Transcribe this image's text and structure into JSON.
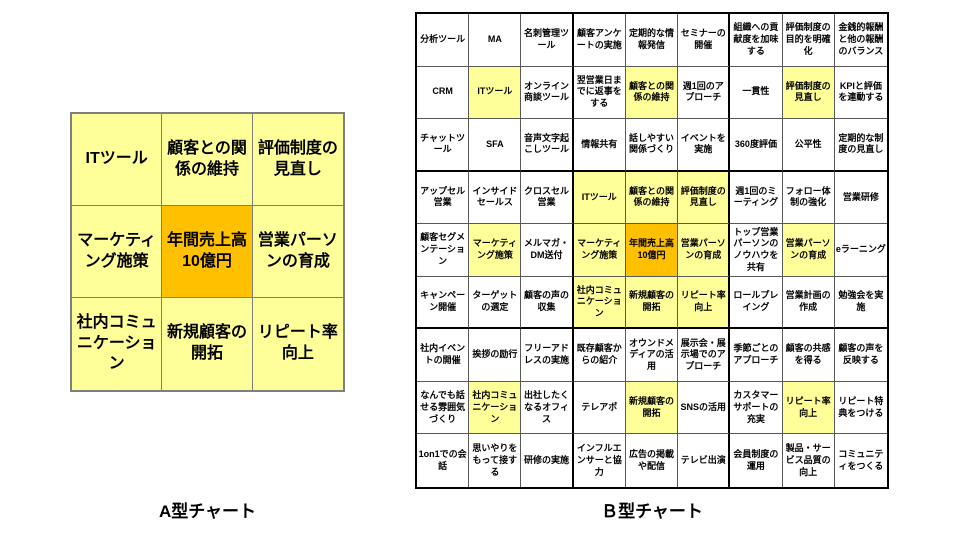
{
  "colors": {
    "highlight_yellow": "#FFFF99",
    "center_orange": "#FFC000",
    "default_white": "#FFFFFF",
    "grid_line_a": "#7F7F7F",
    "grid_line_b_inner": "#595959",
    "grid_line_b_block": "#000000"
  },
  "chart_a": {
    "caption": "А型チャート",
    "rows": [
      [
        {
          "t": "ITツール",
          "c": "yellow"
        },
        {
          "t": "顧客との関係の維持",
          "c": "yellow"
        },
        {
          "t": "評価制度の見直し",
          "c": "yellow"
        }
      ],
      [
        {
          "t": "マーケティング施策",
          "c": "yellow"
        },
        {
          "t": "年間売上高10億円",
          "c": "orange"
        },
        {
          "t": "営業パーソンの育成",
          "c": "yellow"
        }
      ],
      [
        {
          "t": "社内コミュニケーション",
          "c": "yellow"
        },
        {
          "t": "新規顧客の開拓",
          "c": "yellow"
        },
        {
          "t": "リピート率向上",
          "c": "yellow"
        }
      ]
    ]
  },
  "chart_b": {
    "caption": "Ｂ型チャート",
    "rows": [
      [
        {
          "t": "分析ツール",
          "c": "white"
        },
        {
          "t": "MA",
          "c": "white"
        },
        {
          "t": "名刺管理ツール",
          "c": "white"
        },
        {
          "t": "顧客アンケートの実施",
          "c": "white"
        },
        {
          "t": "定期的な情報発信",
          "c": "white"
        },
        {
          "t": "セミナーの開催",
          "c": "white"
        },
        {
          "t": "組織への貢献度を加味する",
          "c": "white"
        },
        {
          "t": "評価制度の目的を明確化",
          "c": "white"
        },
        {
          "t": "金銭的報酬と他の報酬のバランス",
          "c": "white"
        }
      ],
      [
        {
          "t": "CRM",
          "c": "white"
        },
        {
          "t": "ITツール",
          "c": "yellow"
        },
        {
          "t": "オンライン商談ツール",
          "c": "white"
        },
        {
          "t": "翌営業日までに返事をする",
          "c": "white"
        },
        {
          "t": "顧客との関係の維持",
          "c": "yellow"
        },
        {
          "t": "週1回のアプローチ",
          "c": "white"
        },
        {
          "t": "一貫性",
          "c": "white"
        },
        {
          "t": "評価制度の見直し",
          "c": "yellow"
        },
        {
          "t": "KPIと評価を連動する",
          "c": "white"
        }
      ],
      [
        {
          "t": "チャットツール",
          "c": "white"
        },
        {
          "t": "SFA",
          "c": "white"
        },
        {
          "t": "音声文字起こしツール",
          "c": "white"
        },
        {
          "t": "情報共有",
          "c": "white"
        },
        {
          "t": "話しやすい関係づくり",
          "c": "white"
        },
        {
          "t": "イベントを実施",
          "c": "white"
        },
        {
          "t": "360度評価",
          "c": "white"
        },
        {
          "t": "公平性",
          "c": "white"
        },
        {
          "t": "定期的な制度の見直し",
          "c": "white"
        }
      ],
      [
        {
          "t": "アップセル営業",
          "c": "white"
        },
        {
          "t": "インサイドセールス",
          "c": "white"
        },
        {
          "t": "クロスセル営業",
          "c": "white"
        },
        {
          "t": "ITツール",
          "c": "yellow"
        },
        {
          "t": "顧客との関係の維持",
          "c": "yellow"
        },
        {
          "t": "評価制度の見直し",
          "c": "yellow"
        },
        {
          "t": "週1回のミーティング",
          "c": "white"
        },
        {
          "t": "フォロー体制の強化",
          "c": "white"
        },
        {
          "t": "営業研修",
          "c": "white"
        }
      ],
      [
        {
          "t": "顧客セグメンテーション",
          "c": "white"
        },
        {
          "t": "マーケティング施策",
          "c": "yellow"
        },
        {
          "t": "メルマガ・DM送付",
          "c": "white"
        },
        {
          "t": "マーケティング施策",
          "c": "yellow"
        },
        {
          "t": "年間売上高10億円",
          "c": "orange"
        },
        {
          "t": "営業パーソンの育成",
          "c": "yellow"
        },
        {
          "t": "トップ営業パーソンのノウハウを共有",
          "c": "white"
        },
        {
          "t": "営業パーソンの育成",
          "c": "yellow"
        },
        {
          "t": "eラーニング",
          "c": "white"
        }
      ],
      [
        {
          "t": "キャンペーン開催",
          "c": "white"
        },
        {
          "t": "ターゲットの選定",
          "c": "white"
        },
        {
          "t": "顧客の声の収集",
          "c": "white"
        },
        {
          "t": "社内コミュニケーション",
          "c": "yellow"
        },
        {
          "t": "新規顧客の開拓",
          "c": "yellow"
        },
        {
          "t": "リピート率向上",
          "c": "yellow"
        },
        {
          "t": "ロールプレイング",
          "c": "white"
        },
        {
          "t": "営業計画の作成",
          "c": "white"
        },
        {
          "t": "勉強会を実施",
          "c": "white"
        }
      ],
      [
        {
          "t": "社内イベントの開催",
          "c": "white"
        },
        {
          "t": "挨拶の励行",
          "c": "white"
        },
        {
          "t": "フリーアドレスの実施",
          "c": "white"
        },
        {
          "t": "既存顧客からの紹介",
          "c": "white"
        },
        {
          "t": "オウンドメディアの活用",
          "c": "white"
        },
        {
          "t": "展示会・展示場でのアプローチ",
          "c": "white"
        },
        {
          "t": "季節ごとのアプローチ",
          "c": "white"
        },
        {
          "t": "顧客の共感を得る",
          "c": "white"
        },
        {
          "t": "顧客の声を反映する",
          "c": "white"
        }
      ],
      [
        {
          "t": "なんでも話せる雰囲気づくり",
          "c": "white"
        },
        {
          "t": "社内コミュニケーション",
          "c": "yellow"
        },
        {
          "t": "出社したくなるオフィス",
          "c": "white"
        },
        {
          "t": "テレアポ",
          "c": "white"
        },
        {
          "t": "新規顧客の開拓",
          "c": "yellow"
        },
        {
          "t": "SNSの活用",
          "c": "white"
        },
        {
          "t": "カスタマーサポートの充実",
          "c": "white"
        },
        {
          "t": "リピート率向上",
          "c": "yellow"
        },
        {
          "t": "リピート特典をつける",
          "c": "white"
        }
      ],
      [
        {
          "t": "1on1での会話",
          "c": "white"
        },
        {
          "t": "思いやりをもって接する",
          "c": "white"
        },
        {
          "t": "研修の実施",
          "c": "white"
        },
        {
          "t": "インフルエンサーと協力",
          "c": "white"
        },
        {
          "t": "広告の掲載や配信",
          "c": "white"
        },
        {
          "t": "テレビ出演",
          "c": "white"
        },
        {
          "t": "会員制度の運用",
          "c": "white"
        },
        {
          "t": "製品・サービス品質の向上",
          "c": "white"
        },
        {
          "t": "コミュニティをつくる",
          "c": "white"
        }
      ]
    ]
  }
}
